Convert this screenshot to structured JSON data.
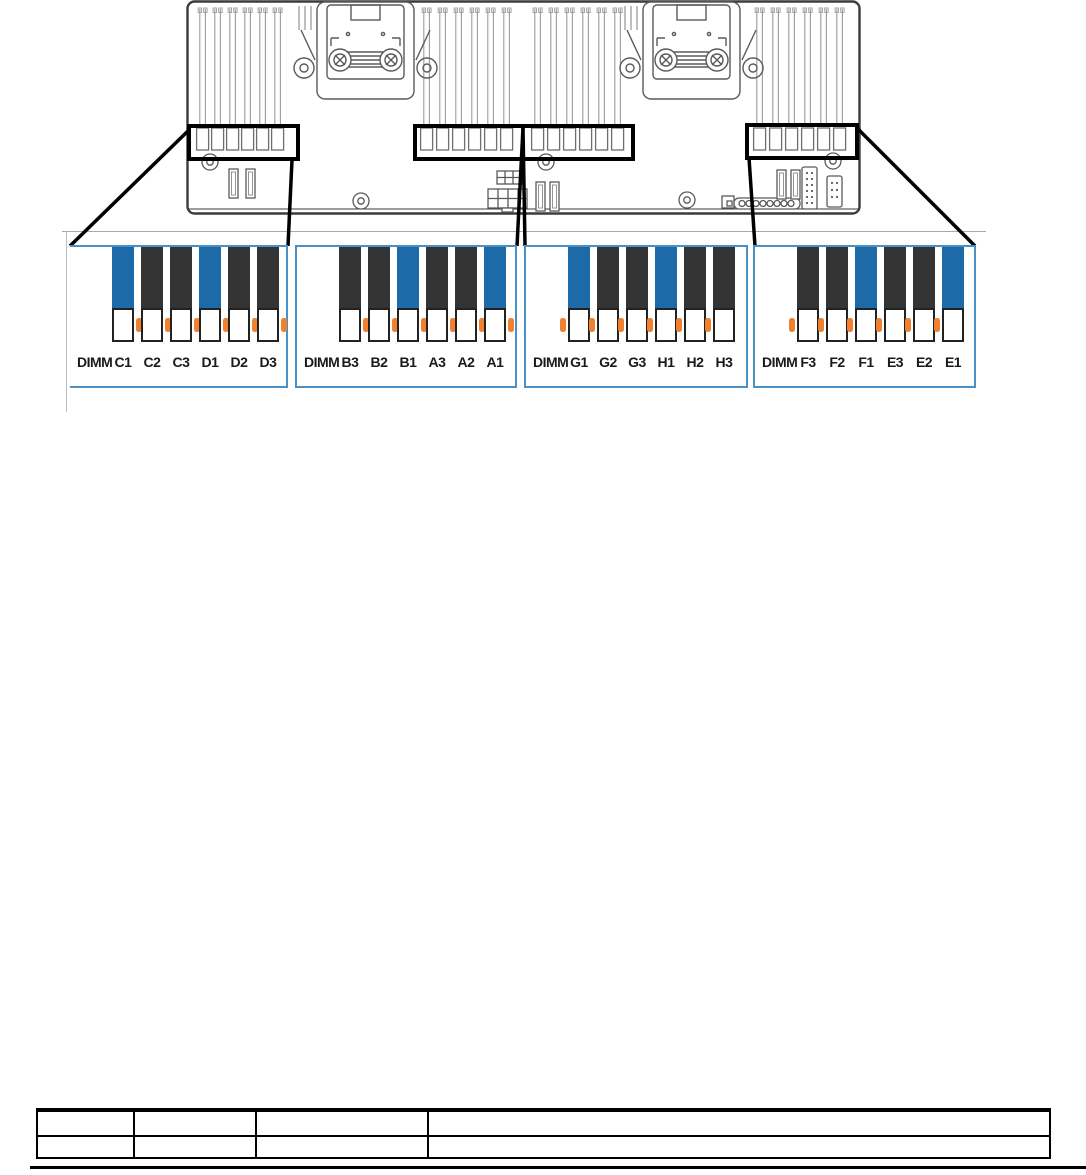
{
  "page": {
    "kind": "server-hardware-manual-page"
  },
  "figure": {
    "description": "system-board DIMM connector locations with four zoomed DIMM bank callouts",
    "colors": {
      "highlight_slot": "#1c6ba8",
      "normal_slot": "#333333",
      "release_tab": "#ef8130",
      "panel_border": "#4a90c4",
      "callout": "#000000",
      "board_line": "#4a4a4a"
    },
    "dimm_panels": [
      {
        "id": "cd",
        "label": "DIMM",
        "tab_side": "right",
        "slots": [
          {
            "name": "C1",
            "highlighted": true
          },
          {
            "name": "C2",
            "highlighted": false
          },
          {
            "name": "C3",
            "highlighted": false
          },
          {
            "name": "D1",
            "highlighted": true
          },
          {
            "name": "D2",
            "highlighted": false
          },
          {
            "name": "D3",
            "highlighted": false
          }
        ]
      },
      {
        "id": "ba",
        "label": "DIMM",
        "tab_side": "right",
        "slots": [
          {
            "name": "B3",
            "highlighted": false
          },
          {
            "name": "B2",
            "highlighted": false
          },
          {
            "name": "B1",
            "highlighted": true
          },
          {
            "name": "A3",
            "highlighted": false
          },
          {
            "name": "A2",
            "highlighted": false
          },
          {
            "name": "A1",
            "highlighted": true
          }
        ]
      },
      {
        "id": "gh",
        "label": "DIMM",
        "tab_side": "left",
        "slots": [
          {
            "name": "G1",
            "highlighted": true
          },
          {
            "name": "G2",
            "highlighted": false
          },
          {
            "name": "G3",
            "highlighted": false
          },
          {
            "name": "H1",
            "highlighted": true
          },
          {
            "name": "H2",
            "highlighted": false
          },
          {
            "name": "H3",
            "highlighted": false
          }
        ]
      },
      {
        "id": "fe",
        "label": "DIMM",
        "tab_side": "left",
        "slots": [
          {
            "name": "F3",
            "highlighted": false
          },
          {
            "name": "F2",
            "highlighted": false
          },
          {
            "name": "F1",
            "highlighted": true
          },
          {
            "name": "E3",
            "highlighted": false
          },
          {
            "name": "E2",
            "highlighted": false
          },
          {
            "name": "E1",
            "highlighted": true
          }
        ]
      }
    ]
  },
  "table": {
    "rows": 2,
    "columns": 4,
    "cells": [
      [
        "",
        "",
        "",
        ""
      ],
      [
        "",
        "",
        "",
        ""
      ]
    ]
  }
}
